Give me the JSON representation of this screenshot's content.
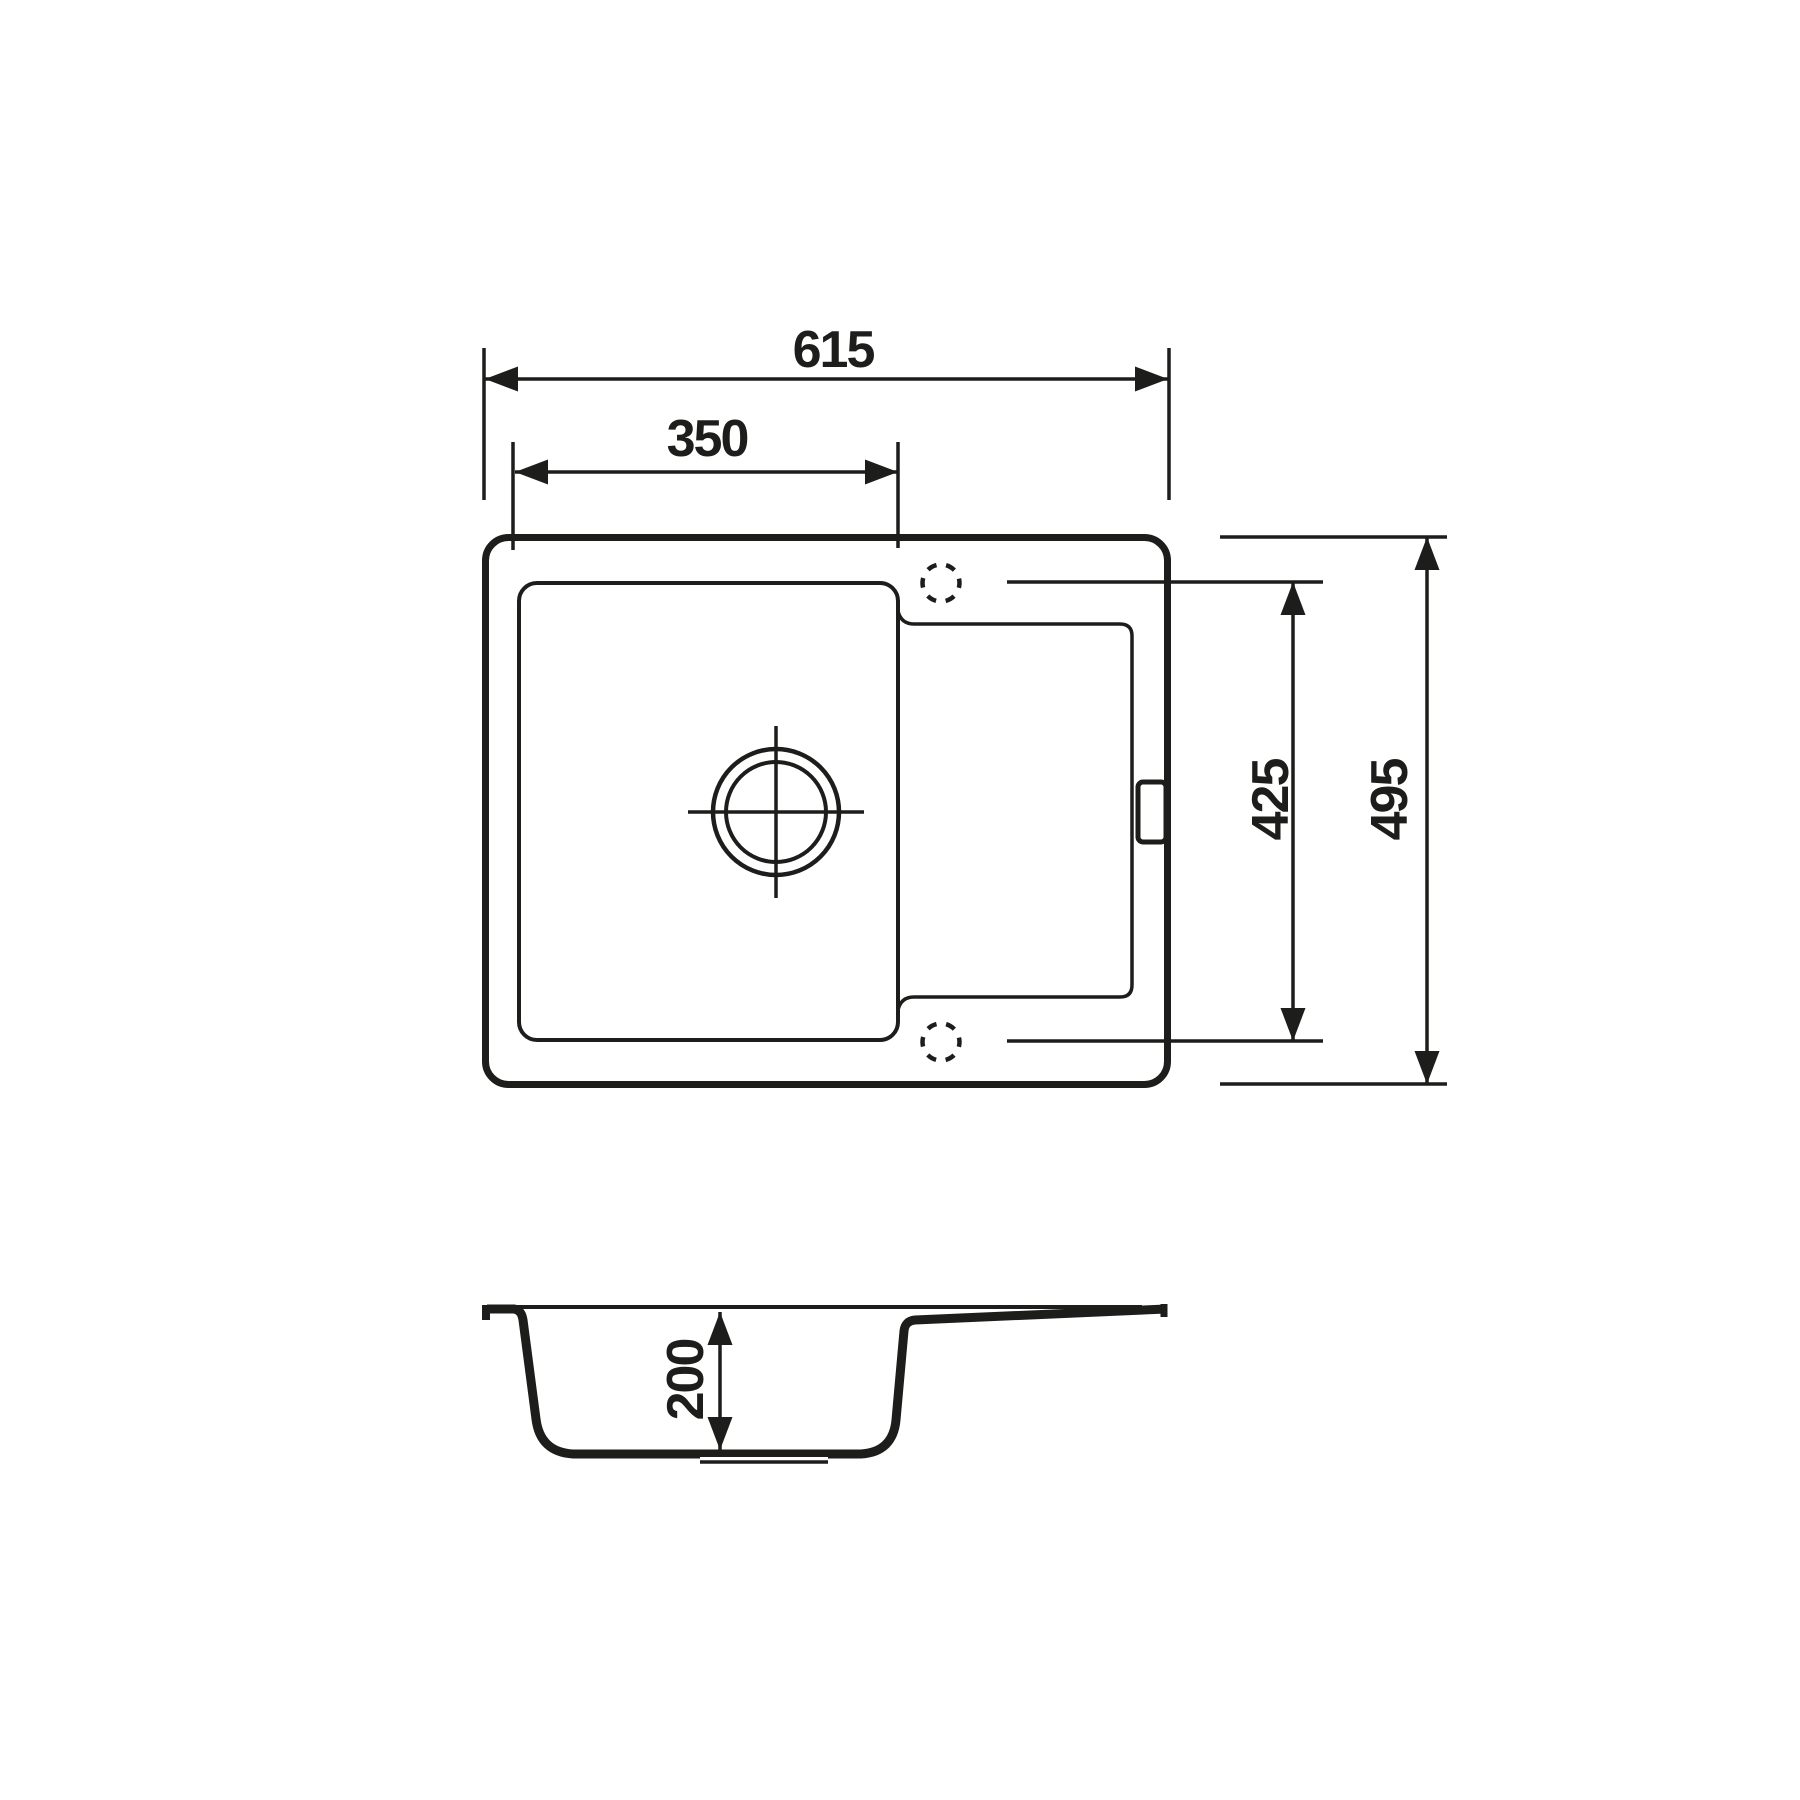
{
  "page": {
    "background_color": "#ffffff",
    "ink_color": "#1d1d1b",
    "content": "kitchen sink technical dimension drawing, top view and section view"
  },
  "dims": {
    "overall_width": "615",
    "bowl_width": "350",
    "hole_spacing_depth": "425",
    "overall_depth": "495",
    "bowl_depth": "200"
  }
}
